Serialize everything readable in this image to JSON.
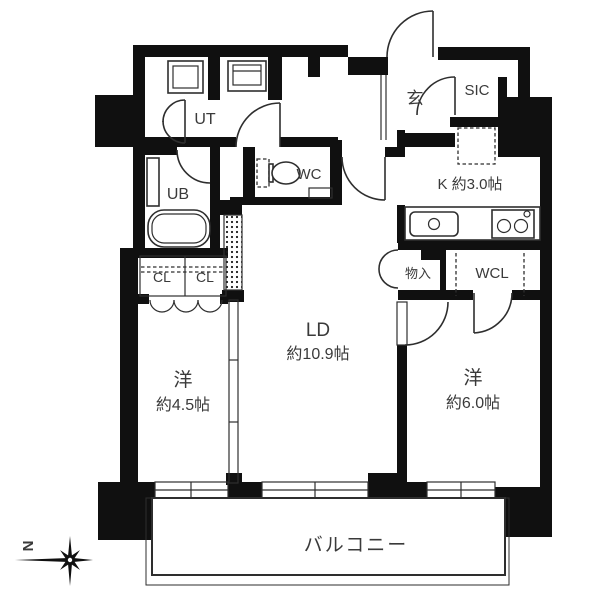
{
  "plan": {
    "rooms": {
      "ut": {
        "label": "UT"
      },
      "genkan": {
        "label": "玄"
      },
      "sic": {
        "label": "SIC"
      },
      "wc": {
        "label": "WC"
      },
      "ub": {
        "label": "UB"
      },
      "kitchen": {
        "label": "K 約3.0帖"
      },
      "closet1": {
        "label": "CL"
      },
      "closet2": {
        "label": "CL"
      },
      "storage": {
        "label": "物入"
      },
      "wcl": {
        "label": "WCL"
      },
      "ld": {
        "label": "LD",
        "size": "約10.9帖"
      },
      "west_room_1": {
        "label": "洋",
        "size": "約4.5帖"
      },
      "west_room_2": {
        "label": "洋",
        "size": "約6.0帖"
      },
      "balcony": {
        "label": "バルコニー"
      }
    },
    "compass": {
      "label": "N"
    },
    "colors": {
      "wall": "#101010",
      "line": "#2e2e2e",
      "text": "#3a3a3a",
      "background": "#ffffff"
    }
  }
}
